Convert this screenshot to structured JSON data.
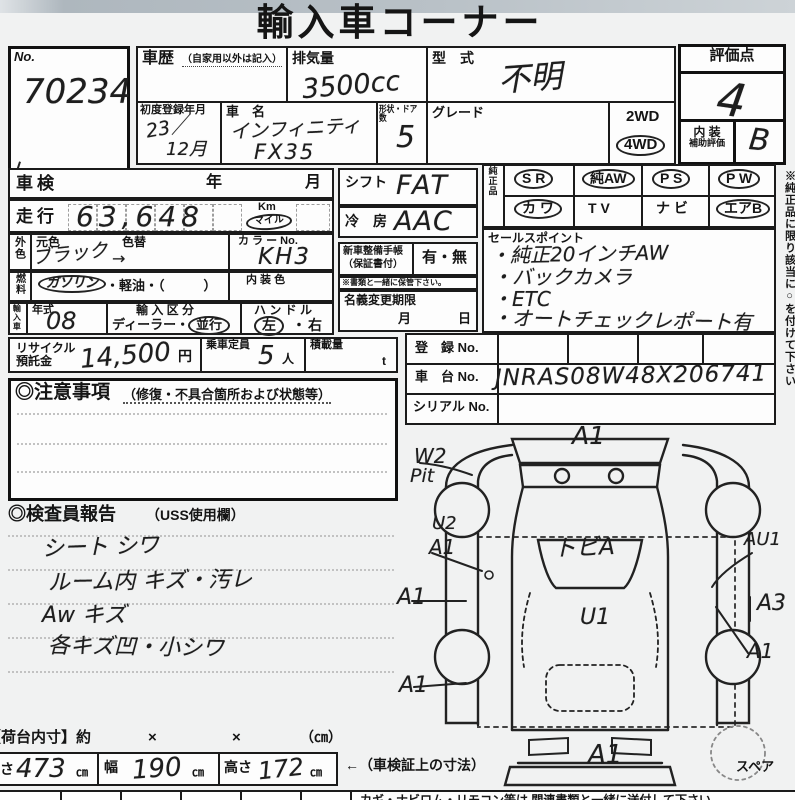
{
  "colors": {
    "paper": "#f1f2f2",
    "ink": "#1b1b1b",
    "hand": "#1e1e1e"
  },
  "page": {
    "title": "輸入車コーナー"
  },
  "top": {
    "no_label": "No.",
    "no_value": "70234",
    "history_label": "車歴",
    "history_note": "（自家用以外は記入）",
    "displacement_label": "排気量",
    "displacement_value": "3500cc",
    "model_label": "型　式",
    "model_value": "不明",
    "first_reg_label": "初度登録年月",
    "first_reg_line1": "23／",
    "first_reg_line2": "12月",
    "name_label": "車　名",
    "name_line1": "インフィニティ",
    "name_line2": "FX35",
    "shape_label": "形状・ドア数",
    "shape_value": "5",
    "grade_label": "グレード",
    "wd2": "2WD",
    "wd4": "4WD",
    "wd4_circled": true,
    "score_label": "評価点",
    "score_value": "4",
    "interior_label1": "内 装",
    "interior_label2": "補助評価",
    "interior_value": "B"
  },
  "side_note": "※純正品に限り該当に○を付けて下さい",
  "left": {
    "shaken_label": "車検",
    "year_label": "年",
    "month_label": "月",
    "mileage_label": "走行",
    "mileage_value": "63,648",
    "unit_km": "Km",
    "unit_mile": "マイル",
    "mile_circled": true,
    "color_label": "外色",
    "color_orig_label": "元色",
    "color_change_label": "色替",
    "color_value": "ブラック",
    "color_arrow": "→",
    "color_no_label": "カ ラ ー No.",
    "color_no_value": "KH3",
    "fuel_label": "燃料",
    "fuel_gasoline": "ガソリン",
    "fuel_gasoline_circled": true,
    "fuel_rest": "・軽油・（　　　）",
    "interior_color_label": "内 装 色",
    "import_vert": "輸入車",
    "year_type_label": "年式",
    "year_type_value": "08",
    "import_class_label": "輸 入 区 分",
    "import_dealer": "ディーラー・",
    "import_parallel": "並行",
    "parallel_circled": true,
    "handle_label": "ハ ン ド ル",
    "handle_left": "左",
    "handle_left_circled": true,
    "handle_dot": "・",
    "handle_right": "右",
    "recycle_label1": "リサイクル",
    "recycle_label2": "預託金",
    "recycle_value": "14,500",
    "recycle_unit": "円",
    "capacity_label": "乗車定員",
    "capacity_value": "5",
    "capacity_unit": "人",
    "load_label": "積載量",
    "load_unit": "t"
  },
  "middle": {
    "shift_label": "シフト",
    "shift_value": "FAT",
    "ac_label": "冷　房",
    "ac_value": "AAC",
    "book_label1": "新車整備手帳",
    "book_label2": "（保証書付）",
    "book_value": "有・無",
    "book_note": "※書類と一緒に保管下さい。",
    "transfer_label": "名義変更期限",
    "transfer_month": "月",
    "transfer_day": "日"
  },
  "genuine": {
    "label": "純正品",
    "items": [
      {
        "text": "S R",
        "circled": true
      },
      {
        "text": "純AW",
        "circled": true
      },
      {
        "text": "P S",
        "circled": true
      },
      {
        "text": "P W",
        "circled": true
      },
      {
        "text": "カ ワ",
        "circled": true
      },
      {
        "text": "T V",
        "circled": false
      },
      {
        "text": "ナ ビ",
        "circled": false
      },
      {
        "text": "エアB",
        "circled": true
      }
    ]
  },
  "sales": {
    "label": "セールスポイント",
    "lines": [
      "・純正20インチAW",
      "・バックカメラ",
      "・ETC",
      "・オートチェックレポート有"
    ]
  },
  "reg": {
    "reg_label": "登　録 No.",
    "chassis_label": "車　台 No.",
    "chassis_value": "JNRAS08W48X206741",
    "serial_label": "シリアル No."
  },
  "caution": {
    "title": "◎注意事項",
    "note": "（修復・不具合箇所および状態等）"
  },
  "inspector": {
    "title": "◎検査員報告",
    "note": "（USS使用欄）",
    "lines": [
      "シート シワ",
      "ルーム内 キズ・汚レ",
      "Aw キズ",
      "各キズ凹・小シワ"
    ]
  },
  "diagram": {
    "a1_top": "A1",
    "w2": "W2",
    "pit": "Pit",
    "u2": "U2",
    "u2_a1": "A1",
    "tobi": "トビA",
    "au1": "AU1",
    "a1_left_mid": "A1",
    "a3": "A3",
    "u1": "U1",
    "a1_right_low": "A1",
    "a1_left_low": "A1",
    "a1_bottom": "A1",
    "spare_label": "スペア"
  },
  "dims": {
    "inner_label": "【荷台内寸】約",
    "x1": "×",
    "x2": "×",
    "unit_note": "（㎝）",
    "length_label": "長さ",
    "length_value": "473",
    "length_unit": "㎝",
    "width_label": "幅",
    "width_value": "190",
    "width_unit": "㎝",
    "height_label": "高さ",
    "height_value": "172",
    "height_unit": "㎝",
    "arrow_note": "←（車検証上の寸法）"
  },
  "bottom_note": "カギ・ナビロム・リモコン等は 関連書類と一緒に送付して下さい。"
}
